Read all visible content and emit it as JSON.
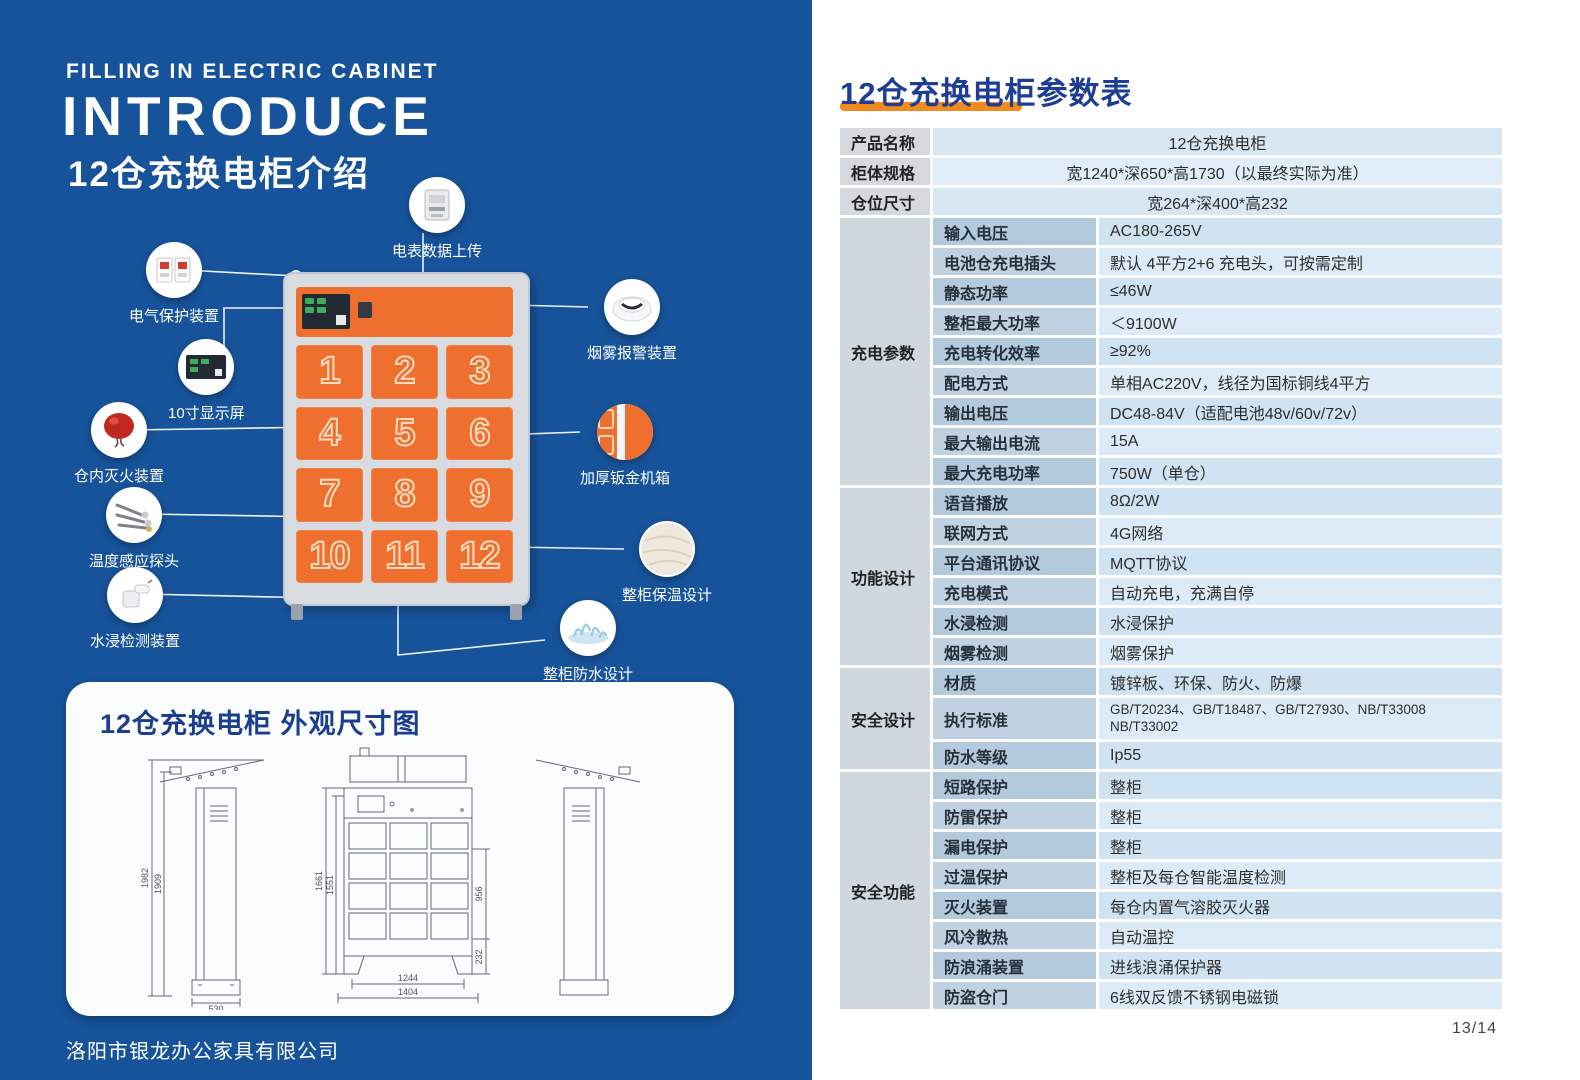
{
  "colors": {
    "panel_blue": "#17539b",
    "accent_orange": "#ee6f2e",
    "heading_blue": "#1d3e94",
    "underline_orange": "#f28b1e"
  },
  "left": {
    "title_en_small": "FILLING IN ELECTRIC CABINET",
    "title_en_large": "INTRODUCE",
    "title_zh": "12仓充换电柜介绍",
    "footer": "洛阳市银龙办公家具有限公司",
    "cabinet": {
      "doors": [
        "1",
        "2",
        "3",
        "4",
        "5",
        "6",
        "7",
        "8",
        "9",
        "10",
        "11",
        "12"
      ]
    },
    "callouts": [
      {
        "label": "电表数据上传",
        "icon": "electric-meter"
      },
      {
        "label": "电气保护装置",
        "icon": "circuit-breaker"
      },
      {
        "label": "10寸显示屏",
        "icon": "display-screen"
      },
      {
        "label": "仓内灭火装置",
        "icon": "fire-extinguisher-ball"
      },
      {
        "label": "温度感应探头",
        "icon": "temperature-probe"
      },
      {
        "label": "水浸检测装置",
        "icon": "water-sensor"
      },
      {
        "label": "烟雾报警装置",
        "icon": "smoke-alarm"
      },
      {
        "label": "加厚钣金机箱",
        "icon": "sheet-metal"
      },
      {
        "label": "整柜保温设计",
        "icon": "insulation-ball"
      },
      {
        "label": "整柜防水设计",
        "icon": "water-splash"
      }
    ],
    "dims_panel": {
      "title": "12仓充换电柜  外观尺寸图",
      "side": {
        "h1": "1982",
        "h2": "1909",
        "w": "530"
      },
      "front": {
        "h_outer": "1661",
        "h_inner": "1551",
        "h_right": "956",
        "h_foot": "232",
        "w_inner": "1244",
        "w_outer": "1404"
      }
    }
  },
  "right": {
    "heading": "12仓充换电柜参数表",
    "page_number": "13/14",
    "table": {
      "simple": [
        {
          "label": "产品名称",
          "value": "12仓充换电柜"
        },
        {
          "label": "柜体规格",
          "value": "宽1240*深650*高1730（以最终实际为准）"
        },
        {
          "label": "仓位尺寸",
          "value": "宽264*深400*高232"
        }
      ],
      "sections": [
        {
          "category": "充电参数",
          "rows": [
            {
              "label": "输入电压",
              "value": "AC180-265V"
            },
            {
              "label": "电池仓充电插头",
              "value": "默认 4平方2+6 充电头，可按需定制"
            },
            {
              "label": "静态功率",
              "value": "≤46W"
            },
            {
              "label": "整柜最大功率",
              "value": "＜9100W"
            },
            {
              "label": "充电转化效率",
              "value": "≥92%"
            },
            {
              "label": "配电方式",
              "value": "单相AC220V，线径为国标铜线4平方"
            },
            {
              "label": "输出电压",
              "value": "DC48-84V（适配电池48v/60v/72v）"
            },
            {
              "label": "最大输出电流",
              "value": "15A"
            },
            {
              "label": "最大充电功率",
              "value": "750W（单仓）"
            }
          ]
        },
        {
          "category": "功能设计",
          "rows": [
            {
              "label": "语音播放",
              "value": "8Ω/2W"
            },
            {
              "label": "联网方式",
              "value": "4G网络"
            },
            {
              "label": "平台通讯协议",
              "value": "MQTT协议"
            },
            {
              "label": "充电模式",
              "value": "自动充电，充满自停"
            },
            {
              "label": "水浸检测",
              "value": "水浸保护"
            },
            {
              "label": "烟雾检测",
              "value": "烟雾保护"
            }
          ]
        },
        {
          "category": "安全设计",
          "rows": [
            {
              "label": "材质",
              "value": "镀锌板、环保、防火、防爆"
            },
            {
              "label": "执行标准",
              "value": "GB/T20234、GB/T18487、GB/T27930、NB/T33008",
              "value2": "NB/T33002"
            },
            {
              "label": "防水等级",
              "value": "Ip55"
            }
          ]
        },
        {
          "category": "安全功能",
          "rows": [
            {
              "label": "短路保护",
              "value": "整柜"
            },
            {
              "label": "防雷保护",
              "value": "整柜"
            },
            {
              "label": "漏电保护",
              "value": "整柜"
            },
            {
              "label": "过温保护",
              "value": "整柜及每仓智能温度检测"
            },
            {
              "label": "灭火装置",
              "value": "每仓内置气溶胶灭火器"
            },
            {
              "label": "风冷散热",
              "value": "自动温控"
            },
            {
              "label": "防浪涌装置",
              "value": "进线浪涌保护器"
            },
            {
              "label": "防盗仓门",
              "value": "6线双反馈不锈钢电磁锁"
            }
          ]
        }
      ]
    }
  }
}
